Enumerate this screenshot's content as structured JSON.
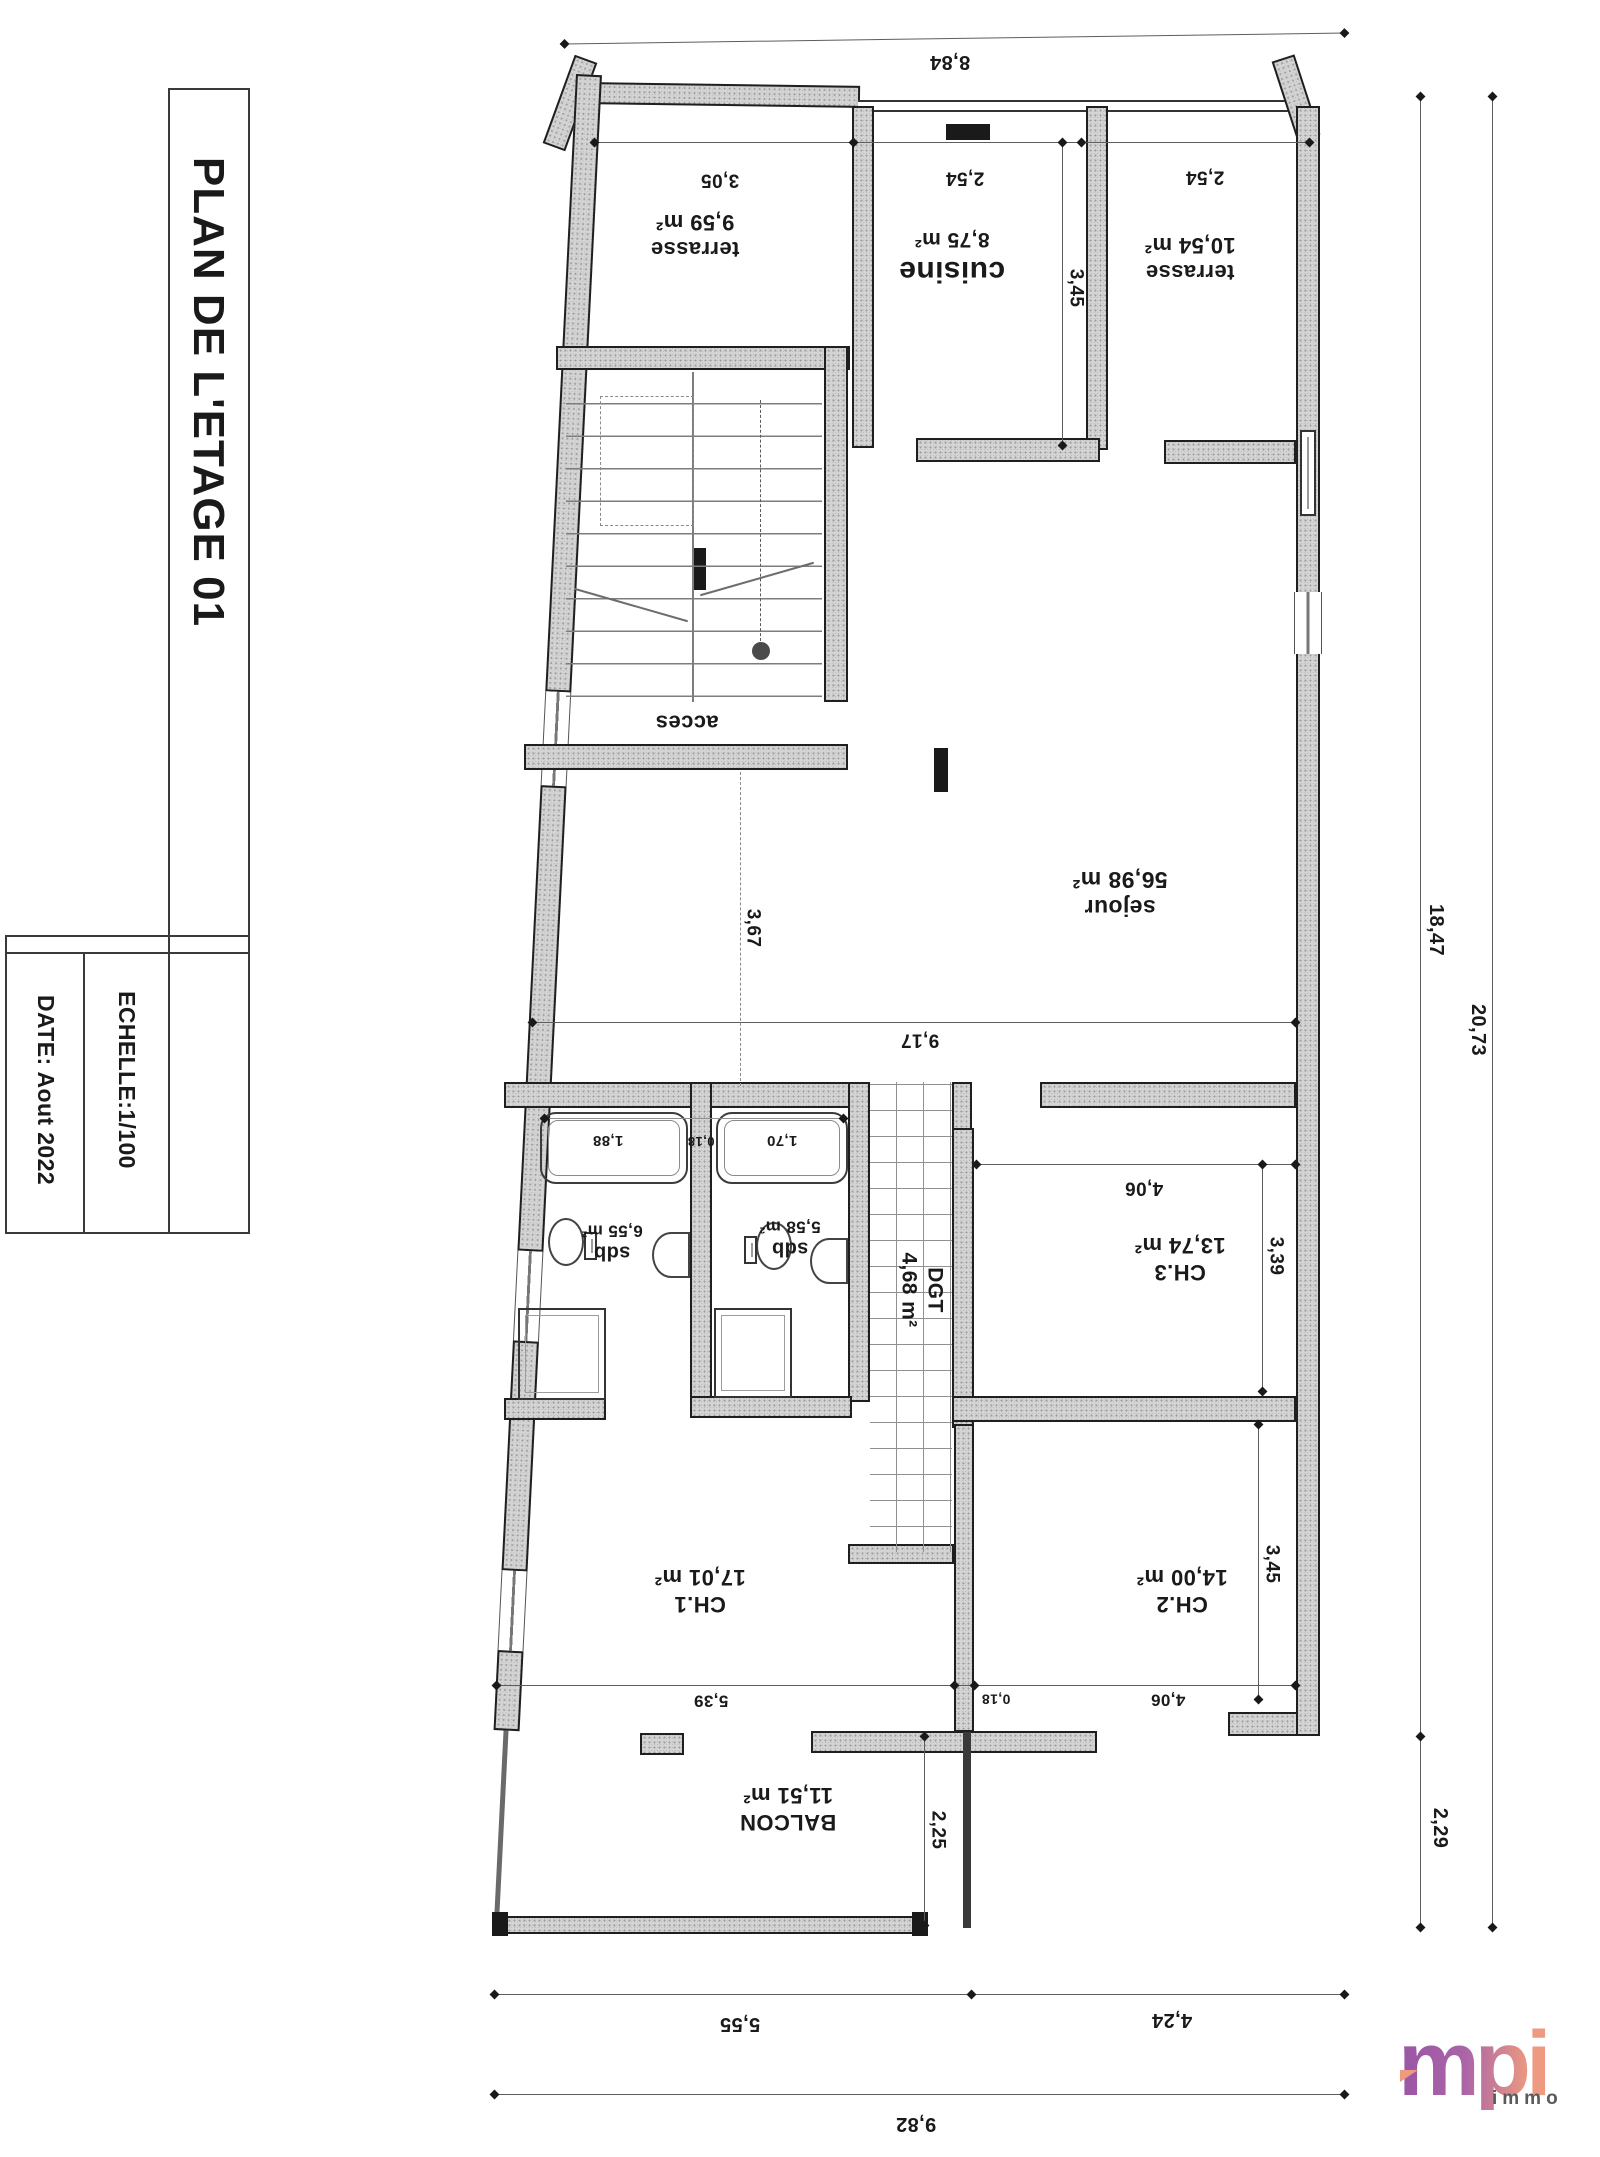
{
  "title_block": {
    "title": "PLAN DE L'ETAGE 01",
    "scale": "ECHELLE:1/100",
    "date": "DATE: Aout 2022"
  },
  "rooms": {
    "terrasse_left": {
      "name": "terrasse",
      "area": "9,59 m²"
    },
    "cuisine": {
      "name": "cuisine",
      "area": "8,75 m²"
    },
    "terrasse_right": {
      "name": "terrasse",
      "area": "10,54 m²"
    },
    "sejour": {
      "name": "sejour",
      "area": "56,98 m²"
    },
    "acces": {
      "name": "acces"
    },
    "sdb_left": {
      "name": "sdb",
      "area": "6,55 m²"
    },
    "sdb_right": {
      "name": "sdb",
      "area": "5,58 m²"
    },
    "degagement": {
      "name": "DGT",
      "area": "4,68 m²"
    },
    "ch1": {
      "name": "CH.1",
      "area": "17,01 m²"
    },
    "ch2": {
      "name": "CH.2",
      "area": "14,00 m²"
    },
    "ch3": {
      "name": "CH.3",
      "area": "13,74 m²"
    },
    "balcon": {
      "name": "BALCON",
      "area": "11,51 m²"
    }
  },
  "dims": {
    "top_width": "8,84",
    "terrasse_left_w": "3,05",
    "cuisine_w": "2,54",
    "terrasse_right_w": "2,54",
    "cuisine_d": "3,45",
    "sejour_w": "9,17",
    "sejour_d": "3,67",
    "tub_left": "1,88",
    "wall_gap_sdb": "0,18",
    "tub_right": "1,70",
    "ch3_w": "4,06",
    "ch3_d": "3,39",
    "ch2_d": "3,45",
    "ch1_w": "5,39",
    "wall_gap_ch": "0,18",
    "ch2_w": "4,06",
    "balcon_d": "2,25",
    "balcon_w": "5,55",
    "right_wing_w": "4,24",
    "total_w": "9,82",
    "side_main": "18,47",
    "side_total": "20,73",
    "side_balcon": "2,29"
  },
  "logo": {
    "brand": "mpi",
    "suffix": "immo",
    "color_start": "#9c57a5",
    "color_end": "#ee9a80"
  }
}
